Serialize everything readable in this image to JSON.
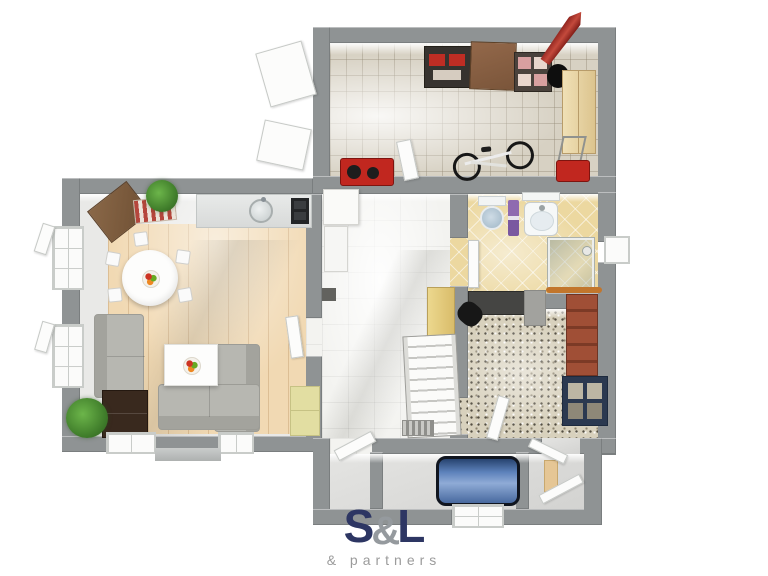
{
  "brand": {
    "logo_s": "S",
    "logo_amp": "&",
    "logo_l": "L",
    "tagline": "& partners",
    "navy": "#2d3663",
    "gray": "#9b9b9b"
  },
  "plan": {
    "view": "top-down-3d-floor-plan",
    "wall_color": "#8f9394",
    "rooms": [
      {
        "name": "storage-room",
        "position": "top",
        "floor": "stone-tile",
        "floor_color": "#d7d1c3",
        "items": [
          "dark-shelving-with-red-boxes",
          "wooden-cabinet",
          "box-shelf",
          "black-stool",
          "red-umbrella",
          "tall-beige-wardrobe",
          "bicycle",
          "red-generator",
          "red-lawnmower",
          "open-exterior-doors"
        ]
      },
      {
        "name": "living-room-kitchen",
        "position": "left",
        "floor": "wood-plank",
        "floor_color": "#f1d9b3",
        "items": [
          "kitchen-counter",
          "round-sink",
          "cooktop",
          "round-dining-table",
          "dining-chairs",
          "fruit-bowl",
          "corner-wood-cabinet",
          "striped-rug",
          "fern-plant",
          "gray-armchair",
          "gray-corner-sofa",
          "white-coffee-table",
          "dark-dresser",
          "green-plant",
          "yellow-cabinet",
          "left-windows",
          "bottom-windows"
        ]
      },
      {
        "name": "hallway",
        "position": "center",
        "floor": "white-tile",
        "floor_color": "#f3f3f0",
        "items": [
          "white-fridge-cabinet",
          "white-tall-cabinet",
          "wall-panel",
          "wooden-wall-shelf",
          "staircase",
          "floor-grate"
        ]
      },
      {
        "name": "bathroom",
        "position": "right-top",
        "floor": "diagonal-yellow-tile",
        "floor_color": "#ecd8a0",
        "items": [
          "toilet",
          "purple-towel-rail",
          "washbasin",
          "mirror-shelf",
          "glass-shower",
          "door"
        ]
      },
      {
        "name": "study-room",
        "position": "right-middle",
        "floor": "terrazzo",
        "floor_color": "#d8d1bd",
        "items": [
          "dark-desk",
          "black-chair",
          "gray-panel",
          "curtain-rail",
          "brick-bookshelf",
          "navy-cabinet",
          "door"
        ]
      },
      {
        "name": "lower-room",
        "position": "bottom",
        "floor": "gray-screed",
        "floor_color": "#dcdcda",
        "items": [
          "blue-sofa",
          "bottom-window",
          "entry-corridor",
          "open-doors"
        ]
      }
    ]
  }
}
